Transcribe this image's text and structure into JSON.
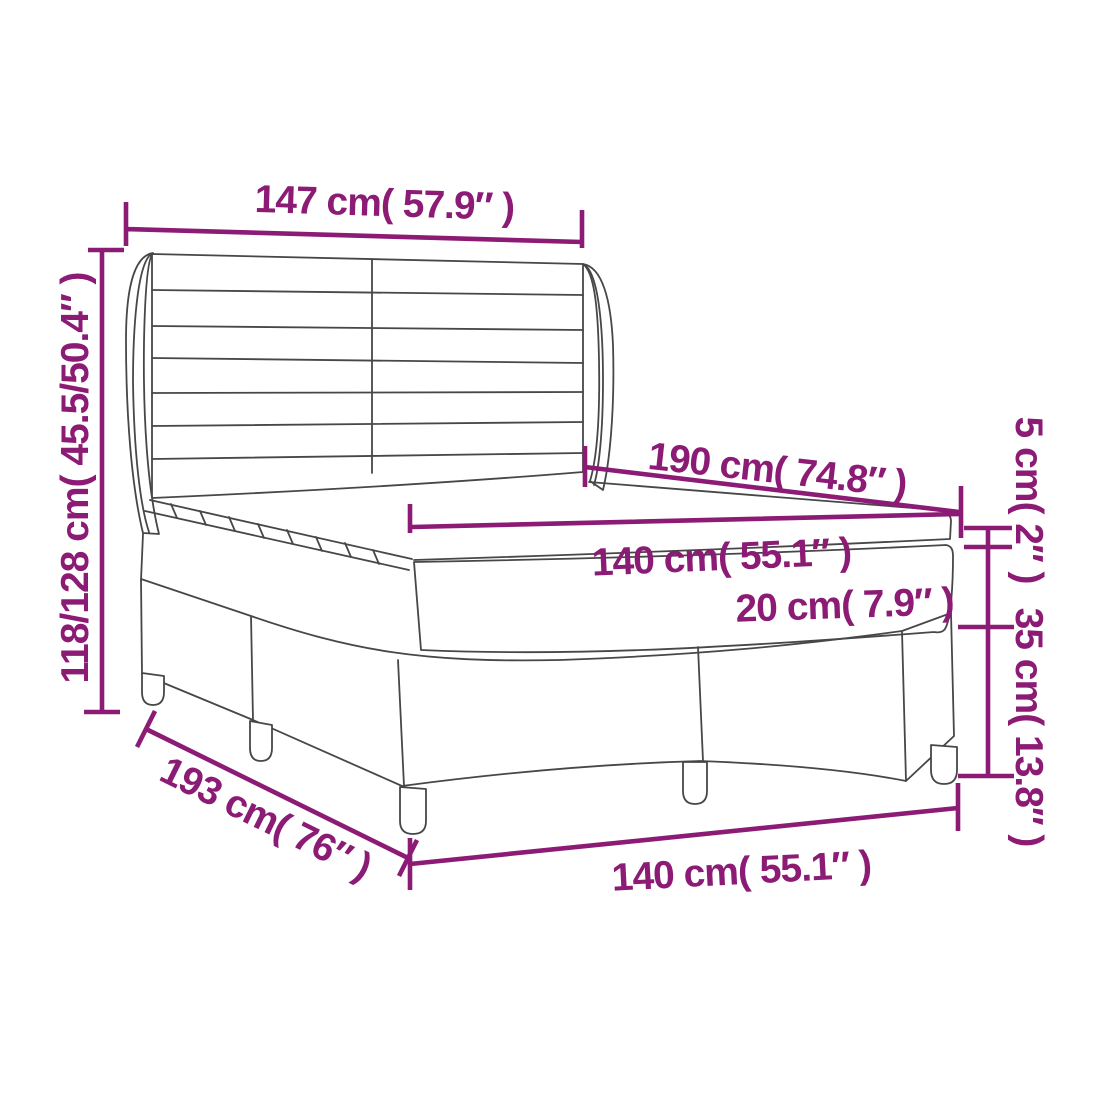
{
  "diagram": {
    "type": "product-dimension-diagram",
    "subject": "box spring bed with winged headboard, mattress and topper",
    "colors": {
      "dimension": "#8b1b74",
      "outline": "#474747",
      "background": "#ffffff"
    },
    "labels": {
      "headboard_width": "147 cm( 57.9″ )",
      "overall_height": "118/128 cm( 45.5/50.4″ )",
      "mattress_length": "190 cm( 74.8″ )",
      "mattress_width": "140 cm( 55.1″ )",
      "mattress_height": "20 cm( 7.9″ )",
      "topper_height": "5 cm( 2″ )",
      "base_height": "35 cm( 13.8″ )",
      "frame_length": "193 cm( 76″ )",
      "frame_width": "140 cm( 55.1″ )"
    }
  }
}
